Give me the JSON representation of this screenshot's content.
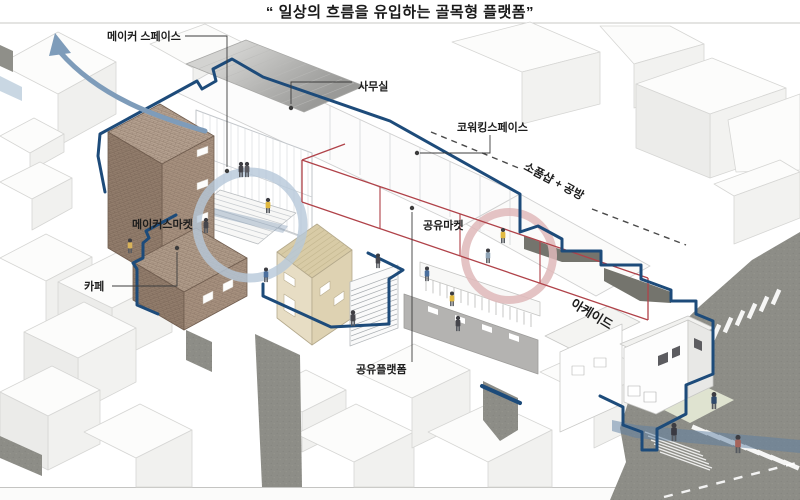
{
  "title": "“ 일상의 흐름을 유입하는 골목형 플랫폼”",
  "labels": {
    "maker_space": "메이커 스페이스",
    "office": "사무실",
    "coworking_space": "코워킹스페이스",
    "prop_shop_workshop": "소품샵 + 공방",
    "makers_market": "메이커스마켓",
    "cafe": "카페",
    "shared_market": "공유마켓",
    "arcade": "아케이드",
    "shared_platform": "공유플랫폼"
  },
  "colors": {
    "site_boundary": "#1d4b7a",
    "arcade_line": "#b04249",
    "flow_arrow": "#7e9cba",
    "highlight_ring_blue": "#b6c8da",
    "highlight_ring_pink": "#dfb8ba",
    "road": "#8d8d87",
    "brick": "#a08b79"
  }
}
